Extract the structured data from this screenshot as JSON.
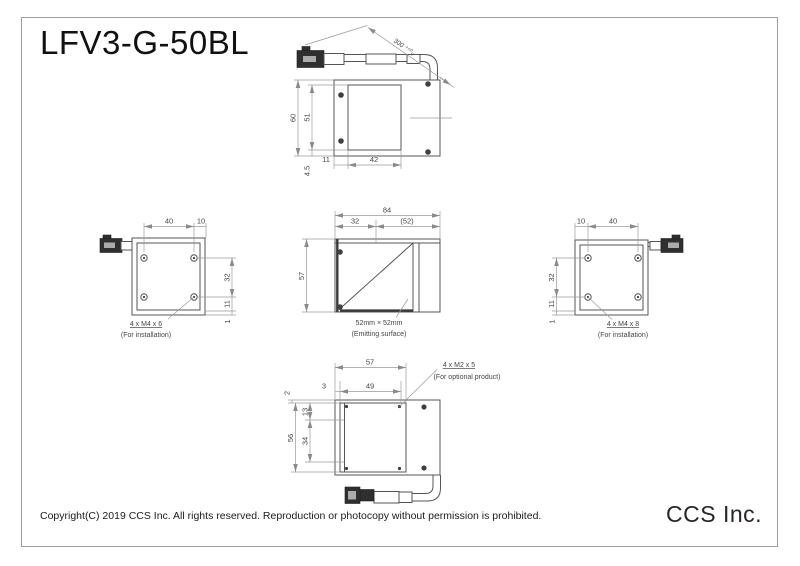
{
  "title": "LFV3-G-50BL",
  "footer": {
    "copyright": "Copyright(C) 2019 CCS Inc. All rights reserved. Reproduction or photocopy without permission is prohibited.",
    "logo": "CCS Inc."
  },
  "views": {
    "top": {
      "dims": {
        "outer_height": "60",
        "window_height": "51",
        "bottom_offset": "4.5",
        "left_margin": "11",
        "window_width": "42",
        "cable_length": "300 ⁺⁵⁰₀"
      }
    },
    "left": {
      "dims": {
        "screw_span": "40",
        "edge_offset": "10",
        "vert_span": "32",
        "vert_lower": "11",
        "vert_edge": "1"
      },
      "note1": "4 x M4 x 6",
      "note2": "(For installation)"
    },
    "front": {
      "dims": {
        "width": "84",
        "left_section": "32",
        "right_section": "(52)",
        "height": "57"
      },
      "note1": "52mm × 52mm",
      "note2": "(Emitting surface)"
    },
    "right": {
      "dims": {
        "edge_offset": "10",
        "screw_span": "40",
        "vert_span": "32",
        "vert_lower": "11",
        "vert_edge": "1"
      },
      "note1": "4 x M4 x 8",
      "note2": "(For installation)"
    },
    "bottom": {
      "dims": {
        "top_width": "57",
        "lip": "3",
        "window_width": "49",
        "edge": "2",
        "upper": "13",
        "mid": "34",
        "height": "56"
      },
      "note1": "4 x M2 x 5",
      "note2": "(For optional product)"
    }
  }
}
